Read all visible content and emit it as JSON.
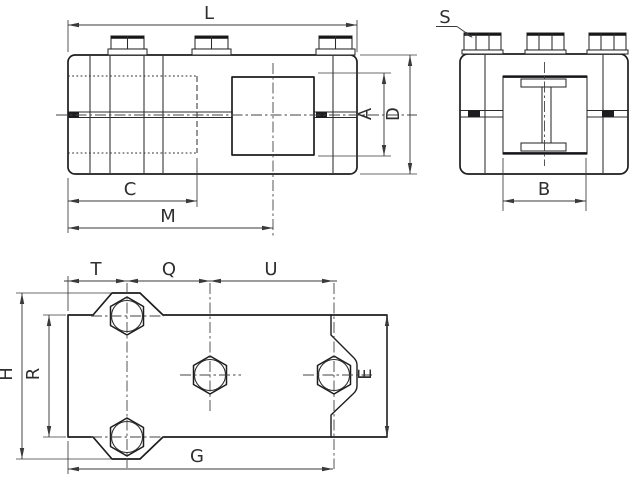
{
  "drawing": {
    "views": {
      "front": {
        "label_L": "L",
        "label_C": "C",
        "label_M": "M",
        "label_A": "A",
        "label_D": "D"
      },
      "end": {
        "label_S": "S",
        "label_B": "B"
      },
      "plan": {
        "label_T": "T",
        "label_Q": "Q",
        "label_U": "U",
        "label_H": "H",
        "label_R": "R",
        "label_E": "E",
        "label_G": "G"
      }
    },
    "colors": {
      "line": "#1d1d1f",
      "dim_line": "#3a3a3c",
      "accent_red": "#cb2a27"
    }
  }
}
